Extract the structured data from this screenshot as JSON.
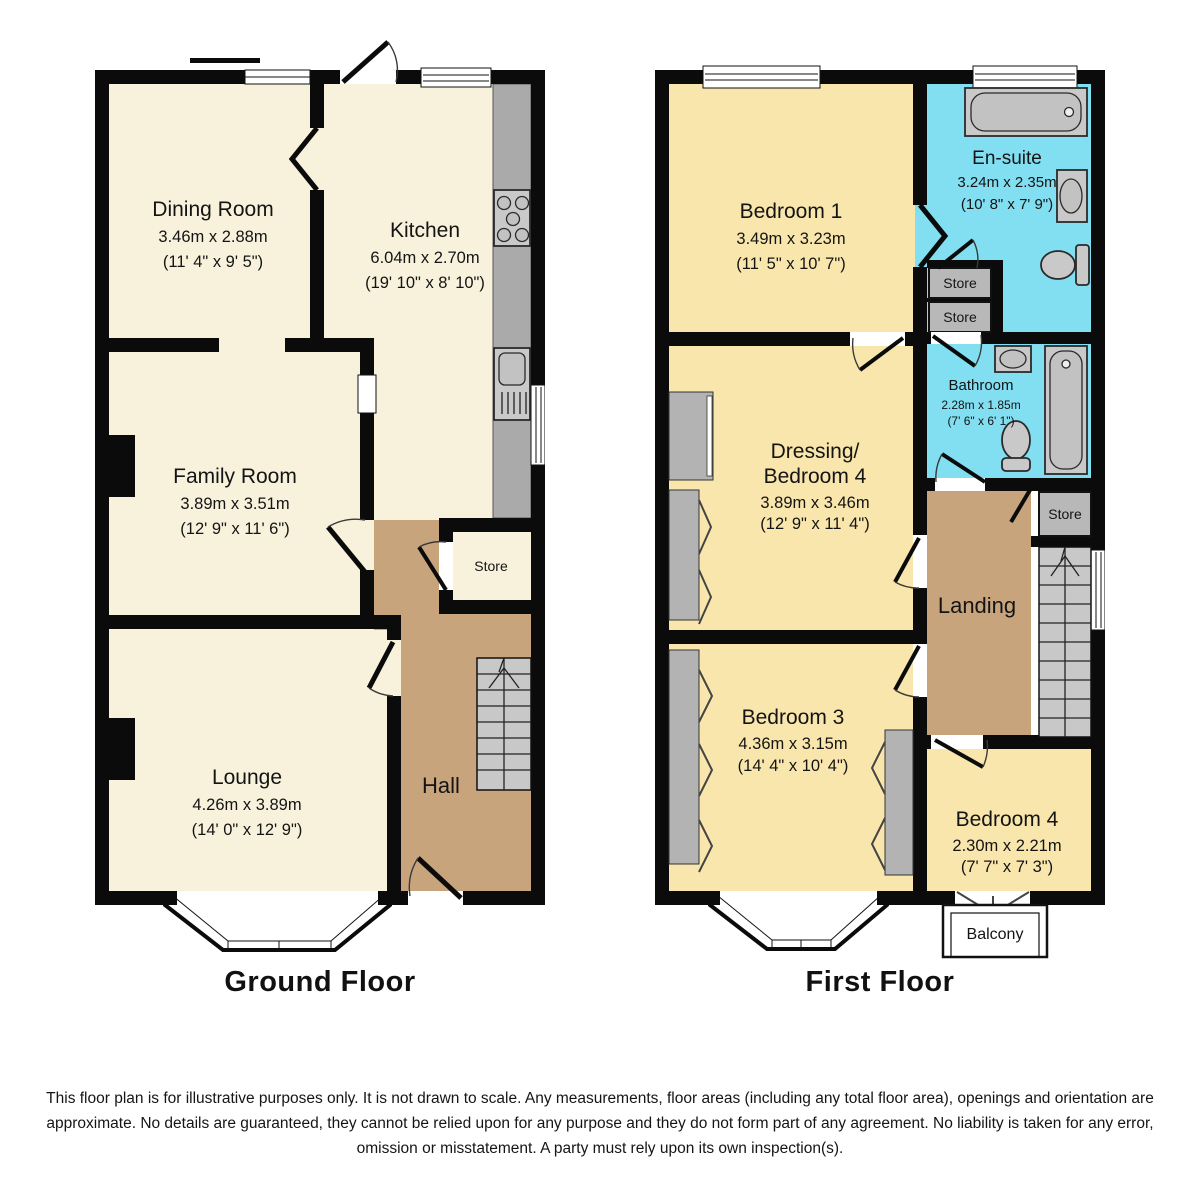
{
  "colors": {
    "wall": "#0b0b0b",
    "ground_room": "#f8f2dd",
    "first_room": "#f9e6ac",
    "hall_tan": "#c8a47d",
    "wet_blue": "#82dff2",
    "store_gray": "#b8b8b8",
    "fixture_gray": "#c9c9c9"
  },
  "ground_floor": {
    "title": "Ground Floor",
    "rooms": {
      "dining": {
        "name": "Dining Room",
        "metric": "3.46m x 2.88m",
        "imperial": "(11' 4\" x 9' 5\")"
      },
      "kitchen": {
        "name": "Kitchen",
        "metric": "6.04m x 2.70m",
        "imperial": "(19' 10\" x 8' 10\")"
      },
      "family": {
        "name": "Family Room",
        "metric": "3.89m x 3.51m",
        "imperial": "(12' 9\" x 11' 6\")"
      },
      "lounge": {
        "name": "Lounge",
        "metric": "4.26m x 3.89m",
        "imperial": "(14' 0\" x 12' 9\")"
      },
      "hall": {
        "name": "Hall"
      },
      "store": {
        "name": "Store"
      }
    }
  },
  "first_floor": {
    "title": "First Floor",
    "rooms": {
      "bedroom1": {
        "name": "Bedroom 1",
        "metric": "3.49m x 3.23m",
        "imperial": "(11' 5\" x 10' 7\")"
      },
      "ensuite": {
        "name": "En-suite",
        "metric": "3.24m x 2.35m",
        "imperial": "(10' 8\" x 7' 9\")"
      },
      "bathroom": {
        "name": "Bathroom",
        "metric": "2.28m x 1.85m",
        "imperial": "(7' 6\" x 6' 1\")"
      },
      "dressing": {
        "name_line1": "Dressing/",
        "name_line2": "Bedroom 4",
        "metric": "3.89m x 3.46m",
        "imperial": "(12' 9\" x 11' 4\")"
      },
      "bedroom3": {
        "name": "Bedroom 3",
        "metric": "4.36m x 3.15m",
        "imperial": "(14' 4\" x 10' 4\")"
      },
      "bedroom4": {
        "name": "Bedroom 4",
        "metric": "2.30m x 2.21m",
        "imperial": "(7' 7\" x 7' 3\")"
      },
      "landing": {
        "name": "Landing"
      },
      "store_top1": {
        "name": "Store"
      },
      "store_top2": {
        "name": "Store"
      },
      "store_landing": {
        "name": "Store"
      },
      "balcony": {
        "name": "Balcony"
      }
    }
  },
  "disclaimer": "This floor plan is for illustrative purposes only. It is not drawn to scale. Any measurements, floor areas (including any total floor area), openings and orientation are approximate. No details are guaranteed, they cannot be relied upon for any purpose and they do not form part of any agreement. No liability is taken for any error, omission or misstatement. A party must rely upon its own inspection(s)."
}
